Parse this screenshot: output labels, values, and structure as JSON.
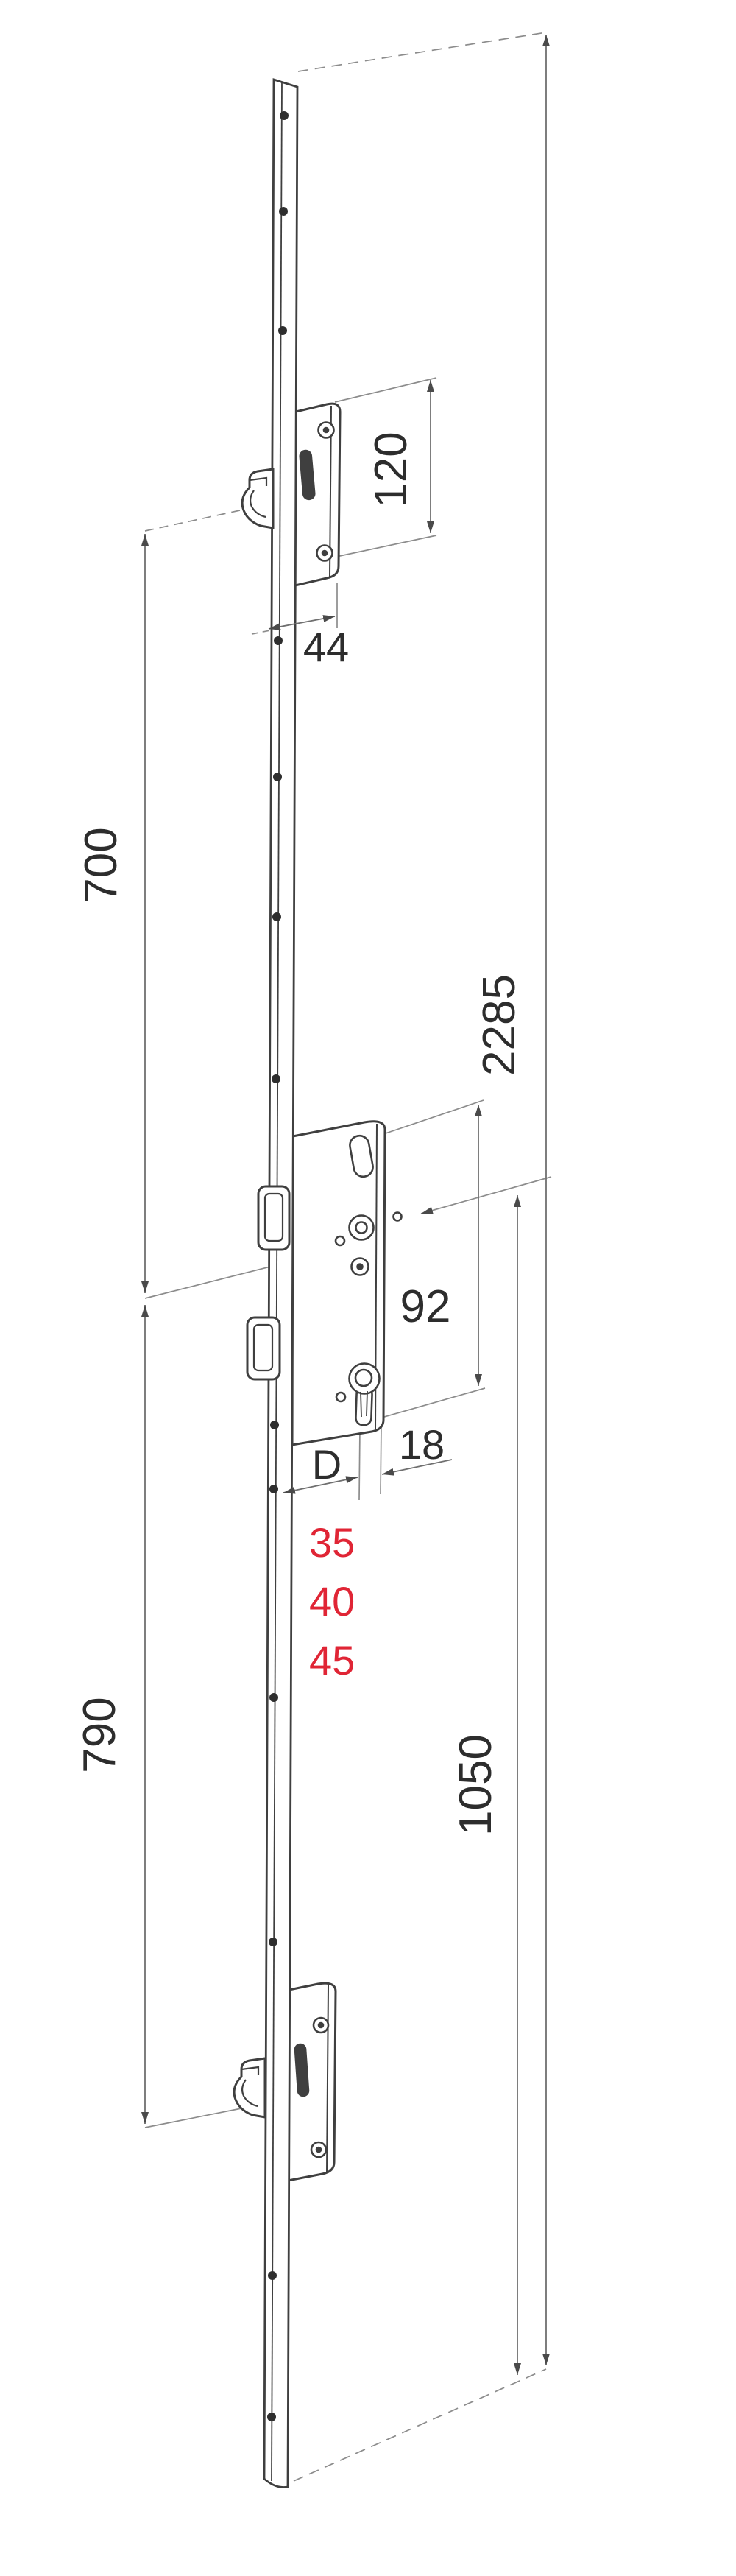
{
  "drawing": {
    "type": "technical-dimension-drawing",
    "subject": "multipoint-lock-faceplate",
    "colors": {
      "background": "#ffffff",
      "body_line": "#3f3f3f",
      "dimension_line": "#6f6f6f",
      "extension_line": "#8c8c8c",
      "label_text": "#2d2d2d",
      "backset_red": "#e02535"
    },
    "labels": {
      "case_height": "120",
      "case_width": "44",
      "upper_hook_spacing": "700",
      "total_length": "2285",
      "hub_to_cylinder": "92",
      "cylinder_to_edge": "18",
      "backset_letter": "D",
      "backset_options": [
        "35",
        "40",
        "45"
      ],
      "lower_hook_spacing": "790",
      "cylinder_to_bottom": "1050"
    }
  }
}
